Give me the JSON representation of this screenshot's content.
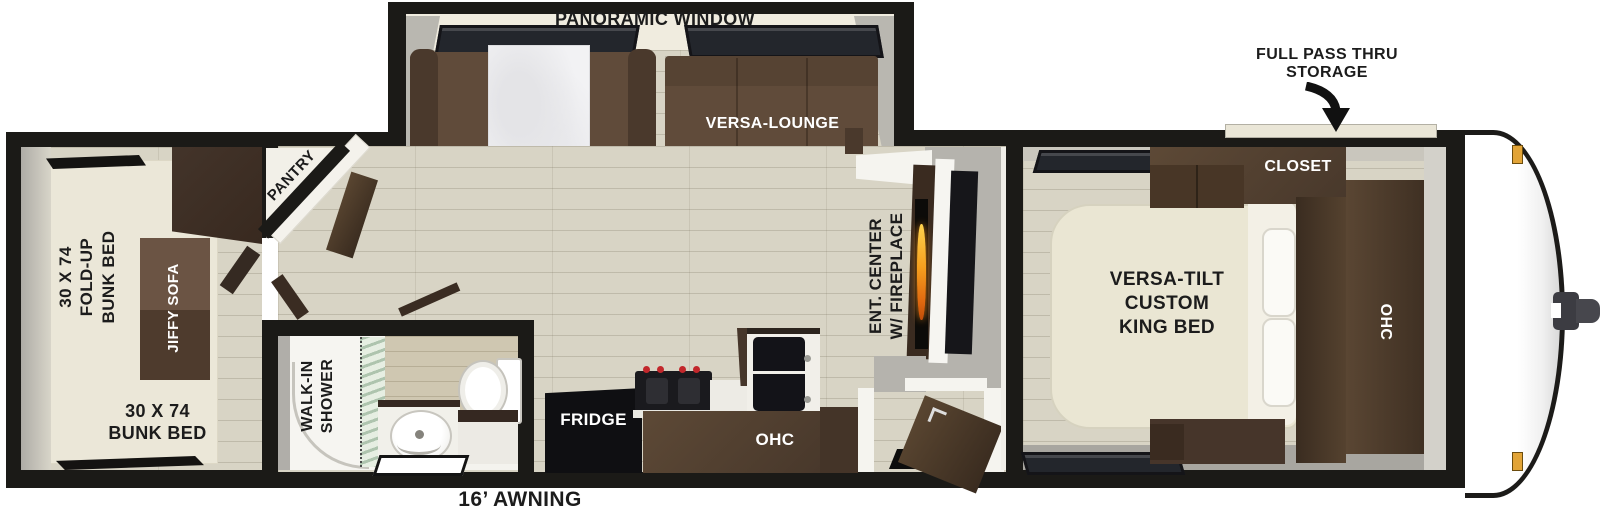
{
  "labels": {
    "panoramic_window": "PANORAMIC WINDOW",
    "versa_lounge": "VERSA-LOUNGE",
    "pass_thru": [
      "FULL PASS THRU",
      "STORAGE"
    ],
    "closet": "CLOSET",
    "king_bed": [
      "VERSA-TILT",
      "CUSTOM",
      "KING BED"
    ],
    "ohc_bedroom": "OHC",
    "ent_center": [
      "ENT. CENTER",
      "W/ FIREPLACE"
    ],
    "pantry": "PANTRY",
    "fold_up_bunk": [
      "30 X 74",
      "FOLD-UP",
      "BUNK BED"
    ],
    "jiffy_sofa": "JIFFY SOFA",
    "bunk_bed": [
      "30 X 74",
      "BUNK BED"
    ],
    "walk_in_shower": [
      "WALK-IN",
      "SHOWER"
    ],
    "fridge": "FRIDGE",
    "ohc_kitchen": "OHC",
    "awning": "16’ AWNING"
  },
  "colors": {
    "wall_black": "#1b1a17",
    "cabinet_dark_wood": "#4a392c",
    "sofa_brown": "#604b3a",
    "floor_wood": "#d8d4c5",
    "bed_cream": "#eae6d3",
    "flame_orange": "#f59f1e",
    "marker_amber": "#e2a437",
    "shower_glass_green": "#aec4ae"
  }
}
